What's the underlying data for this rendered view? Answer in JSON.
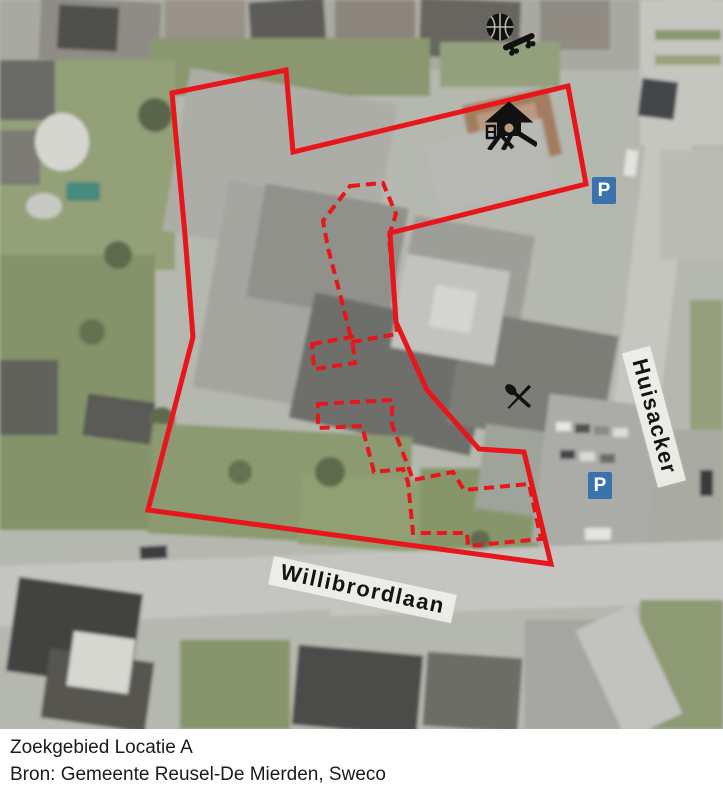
{
  "map": {
    "street_labels": [
      {
        "text": "Huisacker",
        "x": 650,
        "y": 346,
        "rotate": 75
      },
      {
        "text": "Willibrordlaan",
        "x": 274,
        "y": 556,
        "rotate": 12
      }
    ],
    "parking_badges": [
      {
        "label": "P",
        "x": 592,
        "y": 177
      },
      {
        "label": "P",
        "x": 588,
        "y": 472
      }
    ],
    "icons": [
      {
        "id": "basketball",
        "x": 485,
        "y": 12
      },
      {
        "id": "skateboard",
        "x": 499,
        "y": 44,
        "rotate": -24
      },
      {
        "id": "playground",
        "x": 481,
        "y": 102
      },
      {
        "id": "crossed-cutlery",
        "x": 501,
        "y": 379
      }
    ],
    "zone_boundary": {
      "color": "#e8151a",
      "points": [
        [
          172,
          93
        ],
        [
          286,
          70
        ],
        [
          293,
          152
        ],
        [
          568,
          86
        ],
        [
          586,
          184
        ],
        [
          390,
          233
        ],
        [
          396,
          322
        ],
        [
          427,
          390
        ],
        [
          479,
          449
        ],
        [
          524,
          452
        ],
        [
          551,
          564
        ],
        [
          148,
          510
        ],
        [
          193,
          337
        ],
        [
          185,
          235
        ]
      ]
    },
    "building_outlines_dashed": {
      "color": "#e8151a",
      "polygons": [
        [
          [
            350,
            186
          ],
          [
            383,
            183
          ],
          [
            396,
            214
          ],
          [
            389,
            236
          ],
          [
            397,
            334
          ],
          [
            352,
            342
          ],
          [
            343,
            306
          ],
          [
            334,
            271
          ],
          [
            328,
            248
          ],
          [
            323,
            221
          ]
        ],
        [
          [
            312,
            344
          ],
          [
            352,
            337
          ],
          [
            355,
            363
          ],
          [
            314,
            369
          ]
        ],
        [
          [
            318,
            404
          ],
          [
            392,
            400
          ],
          [
            392,
            425
          ],
          [
            408,
            466
          ],
          [
            413,
            480
          ],
          [
            453,
            472
          ],
          [
            464,
            490
          ],
          [
            529,
            484
          ],
          [
            541,
            539
          ],
          [
            468,
            546
          ],
          [
            467,
            533
          ],
          [
            413,
            533
          ],
          [
            408,
            482
          ],
          [
            403,
            469
          ],
          [
            374,
            472
          ],
          [
            362,
            426
          ],
          [
            318,
            428
          ]
        ]
      ]
    }
  },
  "caption": {
    "line1": "Zoekgebied Locatie A",
    "line2": "Bron: Gemeente Reusel-De Mierden, Sweco"
  }
}
